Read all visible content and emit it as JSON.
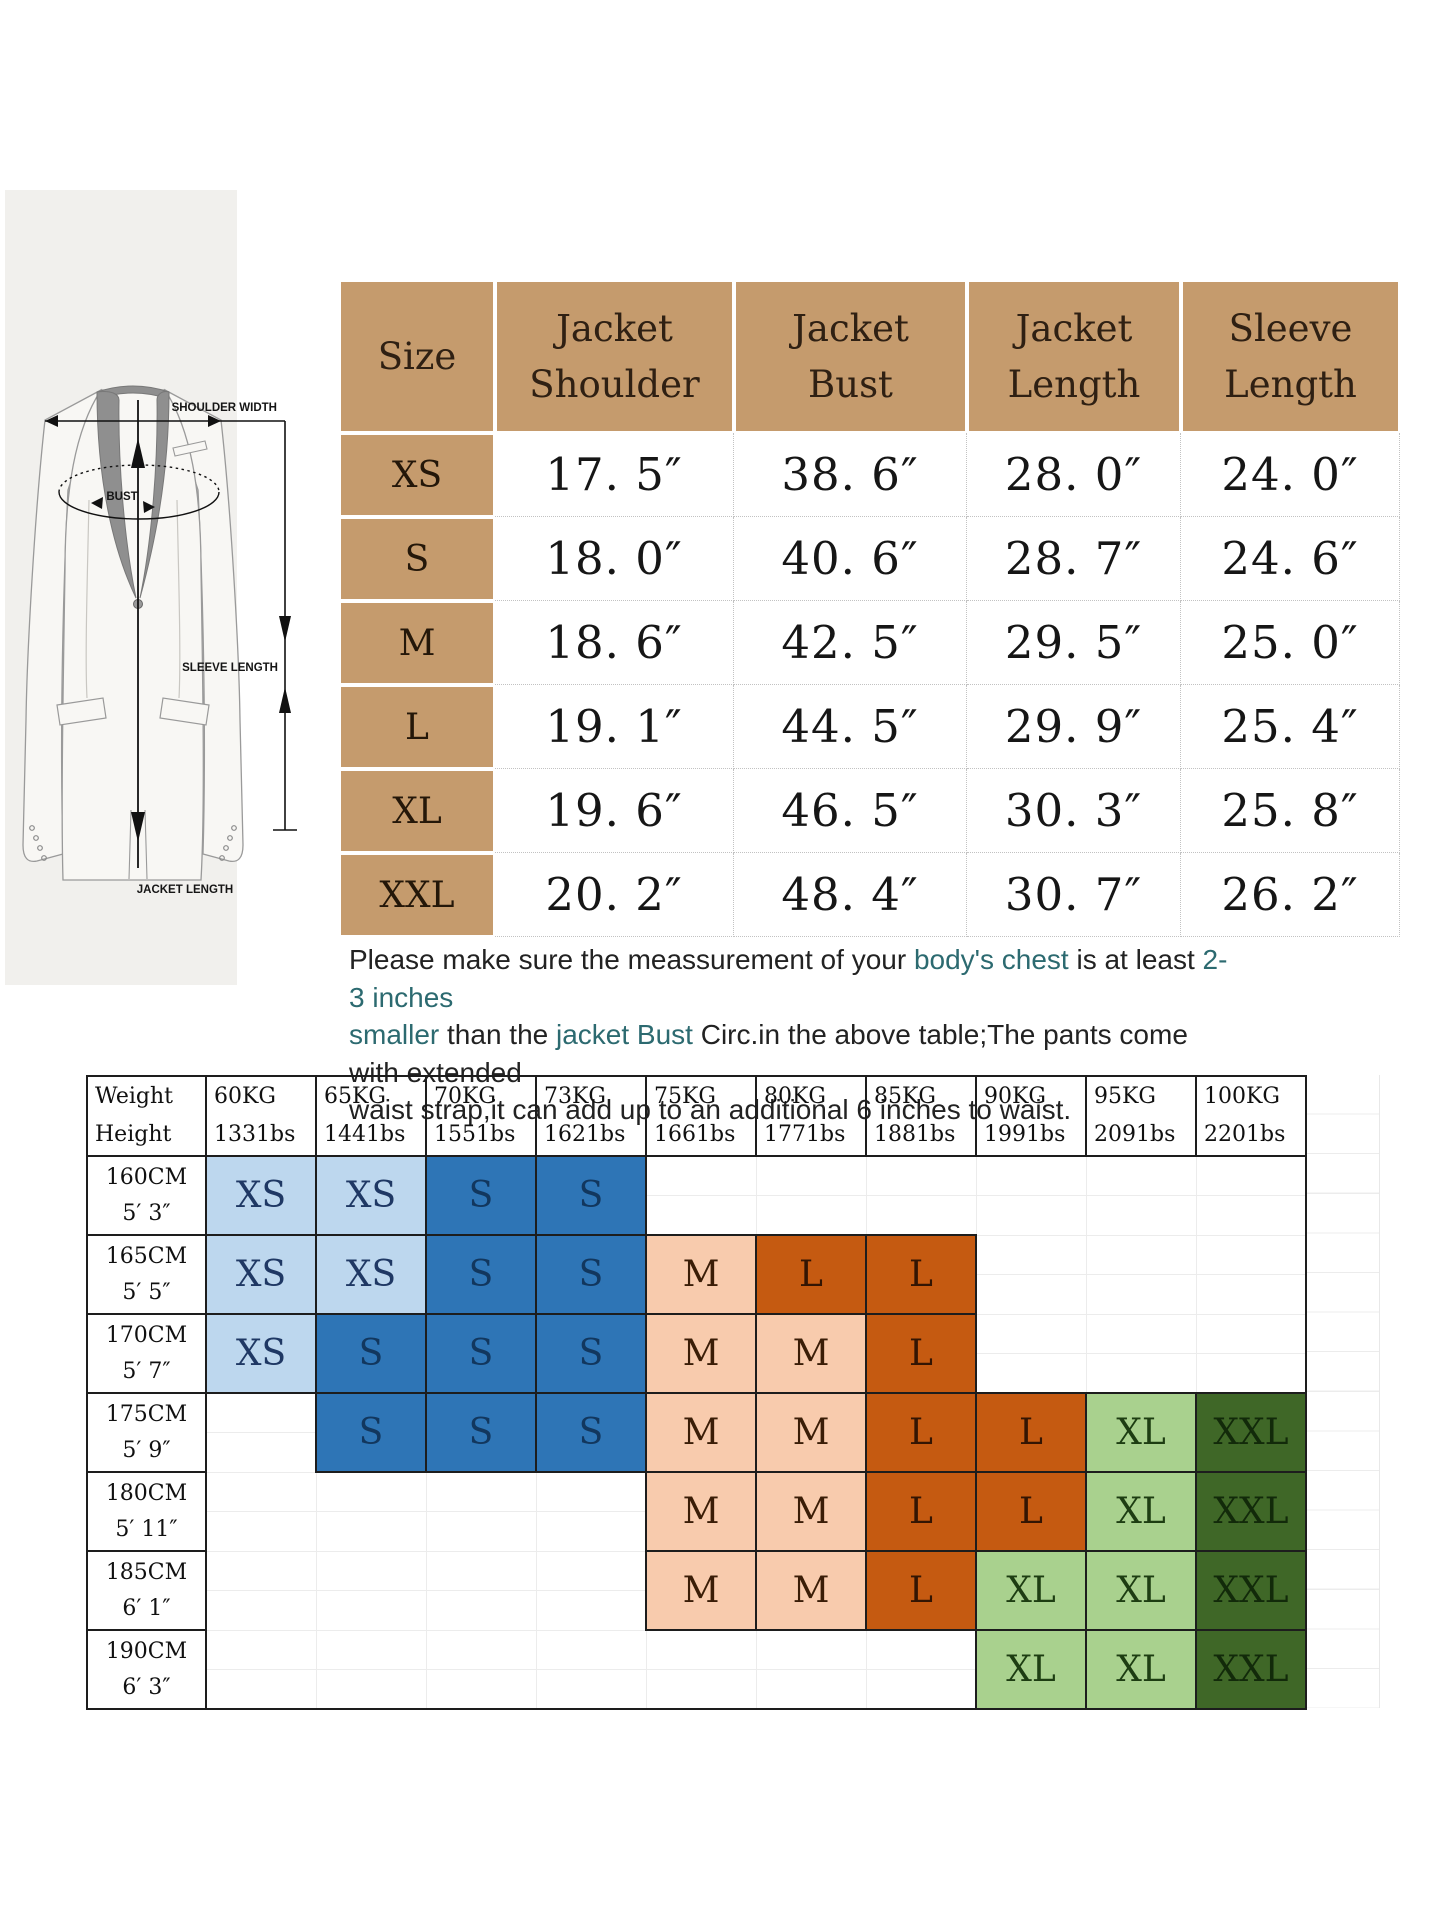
{
  "colors": {
    "tan": "#c59b6d",
    "teal": "#2c6a70",
    "c_lb": "#bdd7ee",
    "t_lb": "#1f3864",
    "c_db": "#2e75b6",
    "t_db": "#12375e",
    "c_pe": "#f8cbad",
    "t_pe": "#3a1d07",
    "c_do": "#c55a11",
    "t_do": "#331503",
    "c_lg": "#a9d18e",
    "t_lg": "#1d3d12",
    "c_dg": "#3f6727",
    "t_dg": "#122a0a"
  },
  "diagram": {
    "labels": {
      "shoulder": "SHOULDER WIDTH",
      "bust": "BUST",
      "sleeve": "SLEEVE LENGTH",
      "jacket": "JACKET LENGTH"
    }
  },
  "size_table": {
    "columns": [
      {
        "key": "size",
        "lines": [
          "Size"
        ]
      },
      {
        "key": "shoulder",
        "lines": [
          "Jacket",
          "Shoulder"
        ]
      },
      {
        "key": "bust",
        "lines": [
          "Jacket",
          "Bust"
        ]
      },
      {
        "key": "length",
        "lines": [
          "Jacket",
          "Length"
        ]
      },
      {
        "key": "sleeve",
        "lines": [
          "Sleeve",
          "Length"
        ]
      }
    ],
    "rows": [
      {
        "size": "XS",
        "shoulder": "17. 5″",
        "bust": "38. 6″",
        "length": "28. 0″",
        "sleeve": "24. 0″"
      },
      {
        "size": "S",
        "shoulder": "18. 0″",
        "bust": "40. 6″",
        "length": "28. 7″",
        "sleeve": "24. 6″"
      },
      {
        "size": "M",
        "shoulder": "18. 6″",
        "bust": "42. 5″",
        "length": "29. 5″",
        "sleeve": "25. 0″"
      },
      {
        "size": "L",
        "shoulder": "19. 1″",
        "bust": "44. 5″",
        "length": "29. 9″",
        "sleeve": "25. 4″"
      },
      {
        "size": "XL",
        "shoulder": "19. 6″",
        "bust": "46. 5″",
        "length": "30. 3″",
        "sleeve": "25. 8″"
      },
      {
        "size": "XXL",
        "shoulder": "20. 2″",
        "bust": "48. 4″",
        "length": "30. 7″",
        "sleeve": "26. 2″"
      }
    ]
  },
  "note": {
    "lines": [
      [
        {
          "t": "Please make sure the meassurement of your ",
          "hl": false
        },
        {
          "t": "body's chest",
          "hl": true
        },
        {
          "t": " is at least ",
          "hl": false
        },
        {
          "t": "2-3 inches",
          "hl": true
        }
      ],
      [
        {
          "t": "smaller",
          "hl": true
        },
        {
          "t": " than the ",
          "hl": false
        },
        {
          "t": "jacket Bust",
          "hl": true
        },
        {
          "t": " Circ.in the above table;The pants come with extended",
          "hl": false
        }
      ],
      [
        {
          "t": "waist strap,it can add up to an additional 6 inches to waist.",
          "hl": false
        }
      ]
    ]
  },
  "fit_matrix": {
    "corner": {
      "top": "Weight",
      "bottom": "Height"
    },
    "weights": [
      {
        "kg": "60KG",
        "lbs": "1331bs"
      },
      {
        "kg": "65KG",
        "lbs": "1441bs"
      },
      {
        "kg": "70KG",
        "lbs": "1551bs"
      },
      {
        "kg": "73KG",
        "lbs": "1621bs"
      },
      {
        "kg": "75KG",
        "lbs": "1661bs"
      },
      {
        "kg": "80KG",
        "lbs": "1771bs"
      },
      {
        "kg": "85KG",
        "lbs": "1881bs"
      },
      {
        "kg": "90KG",
        "lbs": "1991bs"
      },
      {
        "kg": "95KG",
        "lbs": "2091bs"
      },
      {
        "kg": "100KG",
        "lbs": "2201bs"
      }
    ],
    "heights": [
      {
        "cm": "160CM",
        "imp": "5′ 3″"
      },
      {
        "cm": "165CM",
        "imp": "5′ 5″"
      },
      {
        "cm": "170CM",
        "imp": "5′ 7″"
      },
      {
        "cm": "175CM",
        "imp": "5′ 9″"
      },
      {
        "cm": "180CM",
        "imp": "5′ 11″"
      },
      {
        "cm": "185CM",
        "imp": "6′ 1″"
      },
      {
        "cm": "190CM",
        "imp": "6′ 3″"
      }
    ],
    "cells": [
      [
        "XS:lb",
        "XS:lb",
        "S:db",
        "S:db",
        "",
        "",
        "",
        "",
        "",
        ""
      ],
      [
        "XS:lb",
        "XS:lb",
        "S:db",
        "S:db",
        "M:pe",
        "L:do",
        "L:do",
        "",
        "",
        ""
      ],
      [
        "XS:lb",
        "S:db",
        "S:db",
        "S:db",
        "M:pe",
        "M:pe",
        "L:do",
        "",
        "",
        ""
      ],
      [
        "",
        "S:db",
        "S:db",
        "S:db",
        "M:pe",
        "M:pe",
        "L:do",
        "L:do",
        "XL:lg",
        "XXL:dg"
      ],
      [
        "",
        "",
        "",
        "",
        "M:pe",
        "M:pe",
        "L:do",
        "L:do",
        "XL:lg",
        "XXL:dg"
      ],
      [
        "",
        "",
        "",
        "",
        "M:pe",
        "M:pe",
        "L:do",
        "XL:lg",
        "XL:lg",
        "XXL:dg"
      ],
      [
        "",
        "",
        "",
        "",
        "",
        "",
        "",
        "XL:lg",
        "XL:lg",
        "XXL:dg"
      ]
    ]
  }
}
